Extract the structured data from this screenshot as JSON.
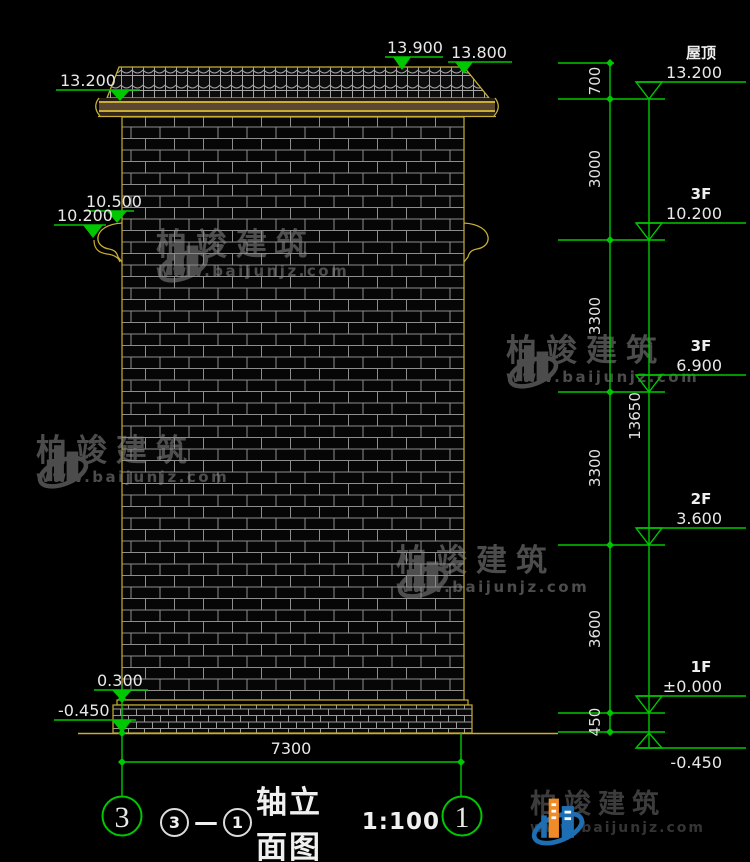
{
  "annotations": {
    "roof_left": "13.200",
    "ridge": "13.900",
    "eave_right": "13.800",
    "bracket_upper": "10.500",
    "bracket_lower": "10.200",
    "plinth_top": "0.300",
    "ground_left": "-0.450",
    "width_dim": "7300"
  },
  "right_column": {
    "segments": [
      "700",
      "3000",
      "3300",
      "3300",
      "3600",
      "450"
    ],
    "overall": "13650",
    "levels": [
      {
        "floor": "屋顶",
        "elev": "13.200"
      },
      {
        "floor": "3F",
        "elev": "10.200"
      },
      {
        "floor": "3F",
        "elev": "6.900"
      },
      {
        "floor": "2F",
        "elev": "3.600"
      },
      {
        "floor": "1F",
        "elev": "±0.000"
      },
      {
        "floor": "",
        "elev": "-0.450"
      }
    ]
  },
  "axes": {
    "left": "3",
    "right": "1"
  },
  "title_block": {
    "circle_a": "3",
    "dash": "—",
    "circle_b": "1",
    "title": "轴立面图",
    "scale": "1:100"
  },
  "watermark": {
    "brand": "柏竣建筑",
    "site": "www.baijunjz.com"
  },
  "logo": {
    "brand": "柏竣建筑",
    "site": "www.baijunjz.com"
  },
  "colors": {
    "dim_green": "#00c800",
    "cad_yellow": "#c7ae35",
    "text_white": "#e8e8e8",
    "logo_blue": "#1e6eb4",
    "logo_orange": "#f08c28"
  }
}
